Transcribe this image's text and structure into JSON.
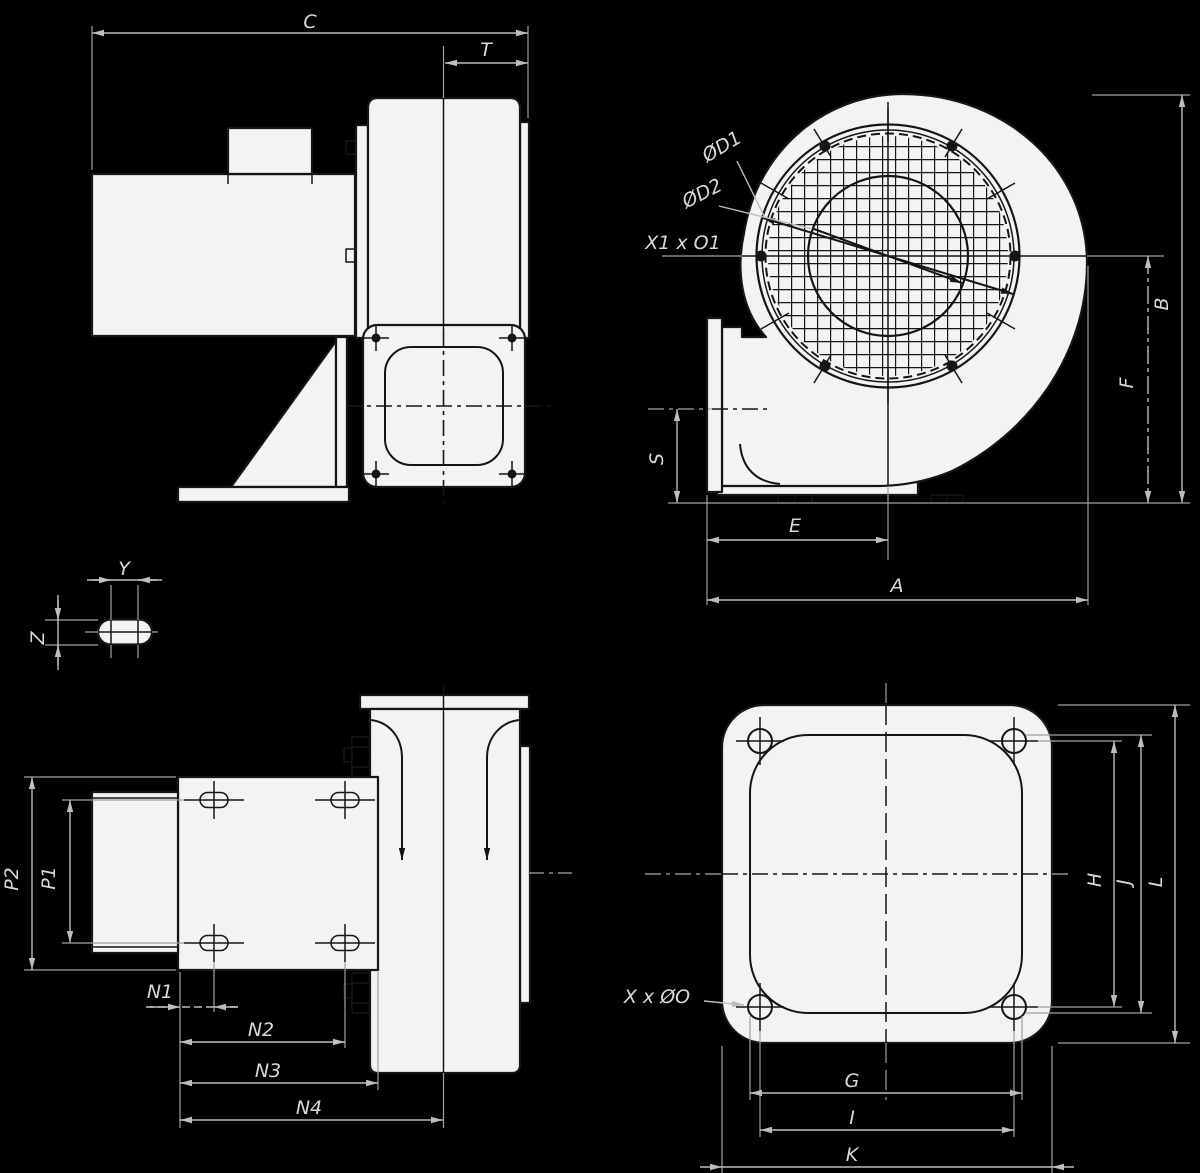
{
  "colors": {
    "background": "#000000",
    "shape_fill": "#f3f3f3",
    "drawing_line": "#151515",
    "dimension_line": "#bdbdbd",
    "label_text": "#d9d9d9"
  },
  "views": {
    "side": {
      "dims": {
        "C": "C",
        "T": "T"
      }
    },
    "front": {
      "dims": {
        "D1": "ØD1",
        "D2": "ØD2",
        "X1O1": "X1 x O1",
        "S": "S",
        "E": "E",
        "A": "A",
        "B": "B",
        "F": "F"
      }
    },
    "slot_detail": {
      "dims": {
        "Y": "Y",
        "Z": "Z"
      }
    },
    "bottom": {
      "dims": {
        "P2": "P2",
        "P1": "P1",
        "N1": "N1",
        "N2": "N2",
        "N3": "N3",
        "N4": "N4"
      }
    },
    "flange": {
      "dims": {
        "XO": "X x ØO",
        "G": "G",
        "I": "I",
        "K": "K",
        "H": "H",
        "J": "J",
        "L": "L"
      }
    }
  }
}
